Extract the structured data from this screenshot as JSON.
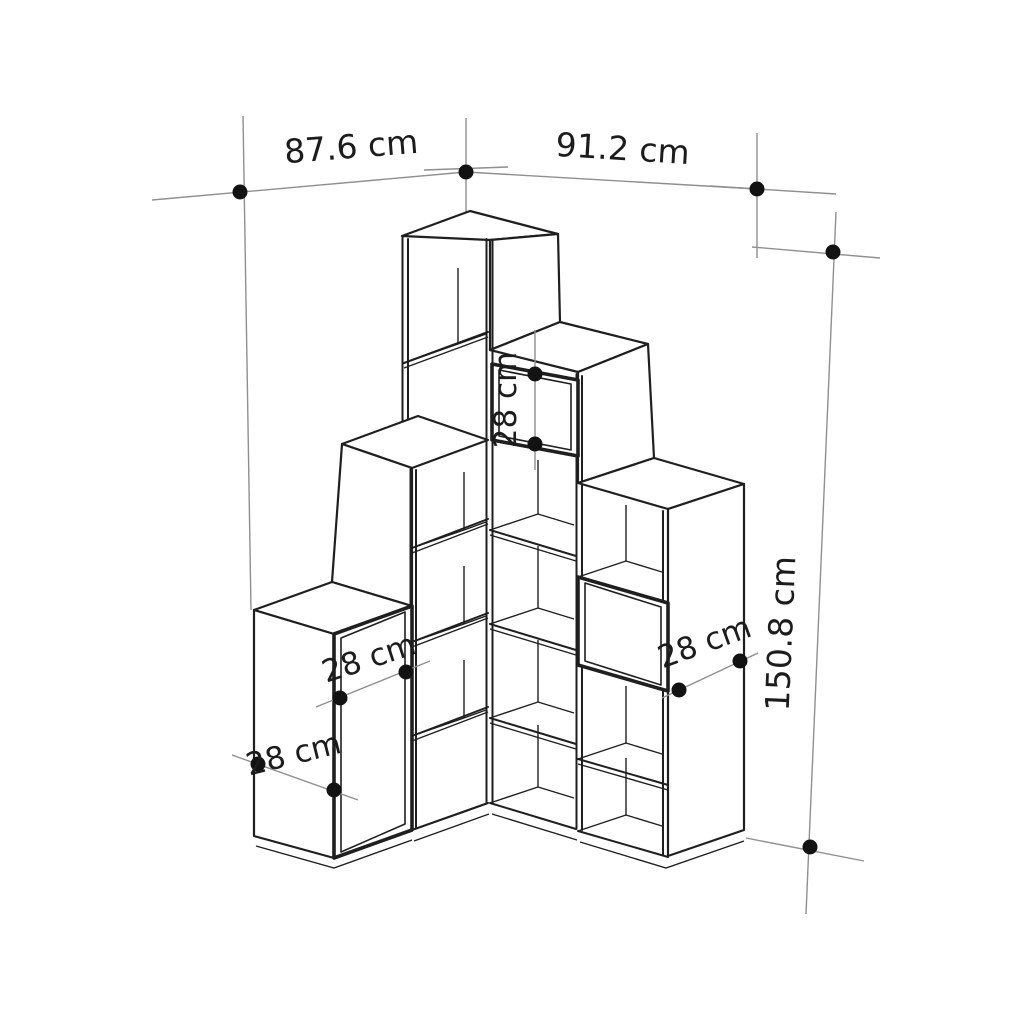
{
  "figure": {
    "type": "furniture-dimension-diagram",
    "subject": "corner step bookcase",
    "background_color": "#ffffff",
    "line_color": "#1f1f1f",
    "guide_color": "#8f8f8f",
    "marker_color": "#121212"
  },
  "dimensions": {
    "left_width": "87.6 cm",
    "right_width": "91.2 cm",
    "total_height": "150.8 cm",
    "left_door_width": "28 cm",
    "left_side_depth": "28 cm",
    "right_door_height": "28 cm",
    "right_side_depth": "28 cm"
  }
}
